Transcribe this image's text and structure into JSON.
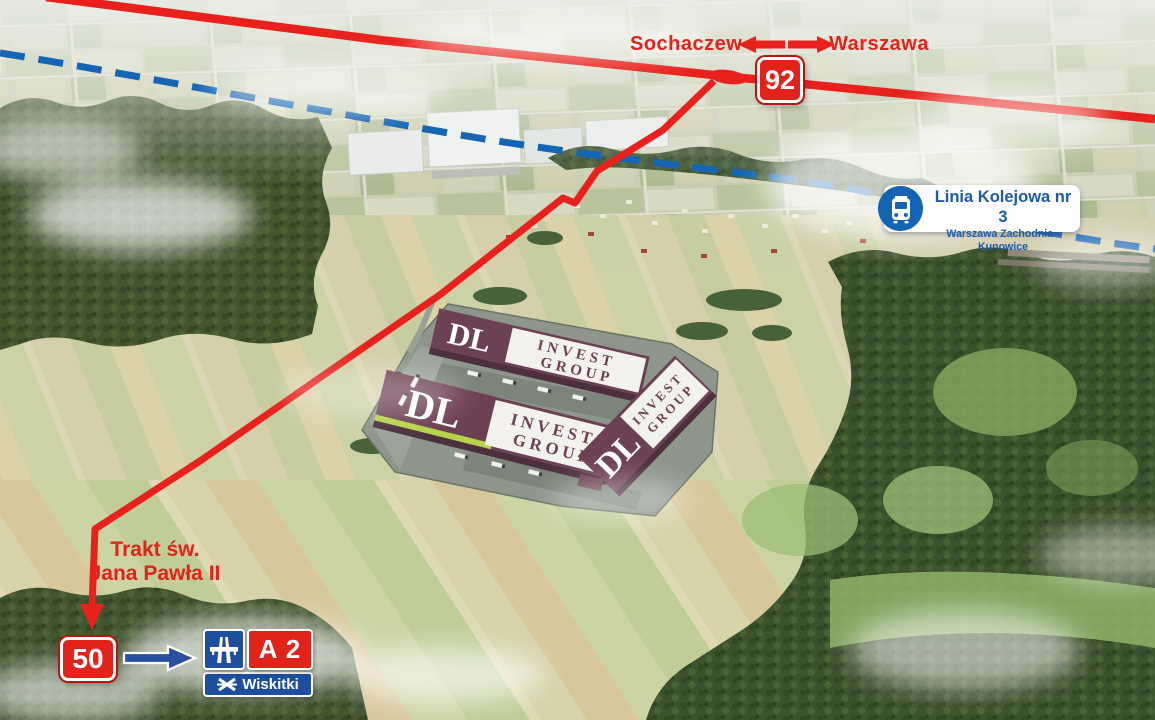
{
  "title": "DL Invest Group logistics park location aerial map",
  "directions": {
    "west": "Sochaczew",
    "east": "Warszawa"
  },
  "road_badges": {
    "national_92": "92",
    "national_50": "50"
  },
  "railway_label": {
    "title": "Linia Kolejowa nr 3",
    "subtitle": "Warszawa Zachodnia - Kunowice"
  },
  "street_label": {
    "line1": "Trakt św.",
    "line2": "Jana Pawła II"
  },
  "motorway_sign": {
    "code": "A 2",
    "exit": "Wiskitki"
  },
  "developer_logo": {
    "name": "DL",
    "line1": "INVEST",
    "line2": "GROUP"
  },
  "icons": [
    "train-icon",
    "motorway-icon",
    "interchange-icon",
    "arrow-west-icon",
    "arrow-east-icon",
    "blue-arrow-icon"
  ],
  "colors": {
    "route_red": "#e2231a",
    "rail_blue": "#1565b4",
    "sign_blue": "#1d4f9e",
    "label_blue": "#1d5ba9",
    "roof_maroon": "#6d4154",
    "logo_panel_white": "#f4f2ee",
    "accent_lime": "#b8d24a"
  }
}
